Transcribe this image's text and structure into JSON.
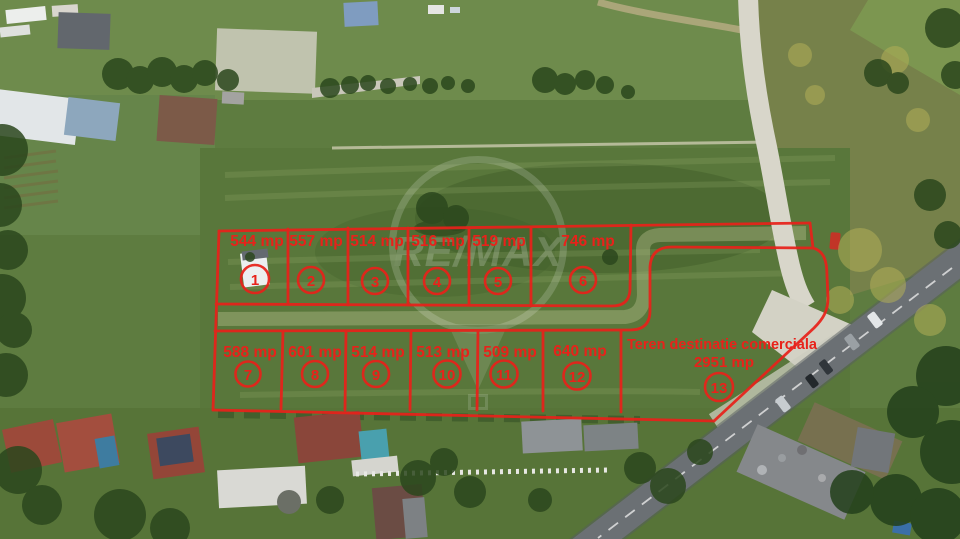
{
  "scene": {
    "description": "Aerial drone photo of land parcels outlined for sale",
    "watermark_brand": "RE/MAX"
  },
  "overlay": {
    "color": "#e8221a",
    "plots": [
      {
        "number": "1",
        "area": "544 mp"
      },
      {
        "number": "2",
        "area": "557 mp"
      },
      {
        "number": "3",
        "area": "514 mp"
      },
      {
        "number": "4",
        "area": "516 mp"
      },
      {
        "number": "5",
        "area": "519 mp"
      },
      {
        "number": "6",
        "area": "746 mp"
      },
      {
        "number": "7",
        "area": "588 mp"
      },
      {
        "number": "8",
        "area": "601 mp"
      },
      {
        "number": "9",
        "area": "514 mp"
      },
      {
        "number": "10",
        "area": "513 mp"
      },
      {
        "number": "11",
        "area": "509 mp"
      },
      {
        "number": "12",
        "area": "640 mp"
      },
      {
        "number": "13",
        "area": "2951 mp",
        "label": "Teren destinatie comerciala"
      }
    ]
  }
}
